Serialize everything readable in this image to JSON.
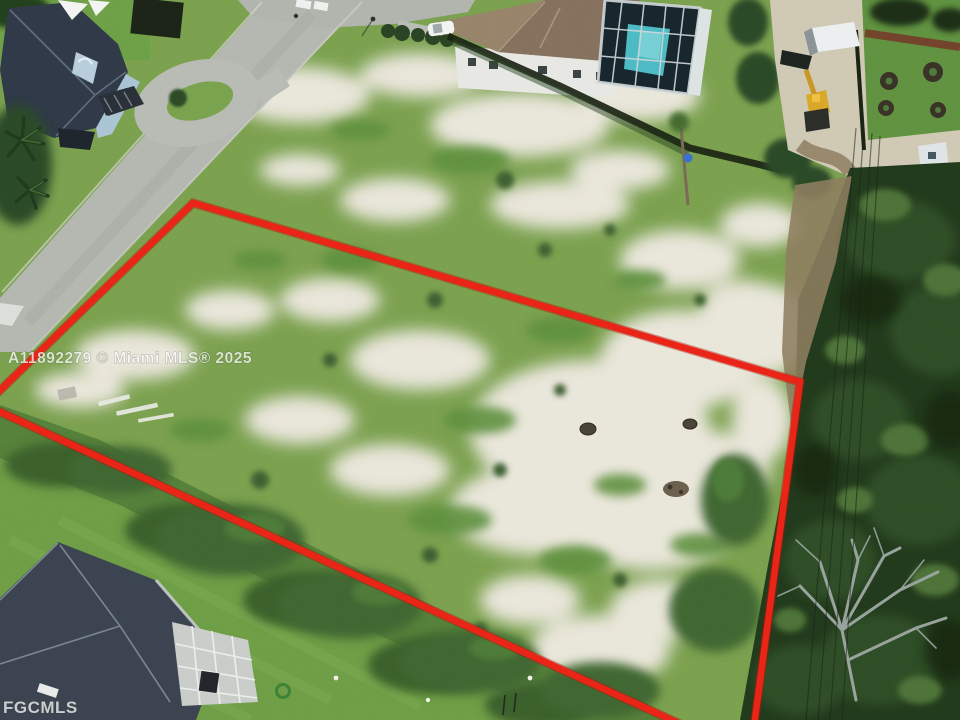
{
  "photo": {
    "kind": "aerial-drone-photo",
    "subject": "vacant residential lot outlined in red",
    "width": 960,
    "height": 720
  },
  "watermarks": {
    "mls_notice": "A11892279 © Miami MLS® 2025",
    "mls_logo": "FGCMLS"
  },
  "lot_outline": {
    "points_str": "193,203 800,382 750,756 -15,405",
    "color": "#ea2315"
  },
  "colors": {
    "outline_red": "#ea2315",
    "sand": "#e9e6da",
    "rough_grass": "#7aa04e",
    "mowed_lawn": "#6d9d45",
    "woods": "#223a1c",
    "road": "#b3b7b0",
    "roof_top_left": "#2f3947",
    "roof_top_center": "#97826a",
    "roof_bottom_left": "#3a434f",
    "pool_water": "#4cbac4",
    "excavator_yellow": "#d9a728"
  }
}
